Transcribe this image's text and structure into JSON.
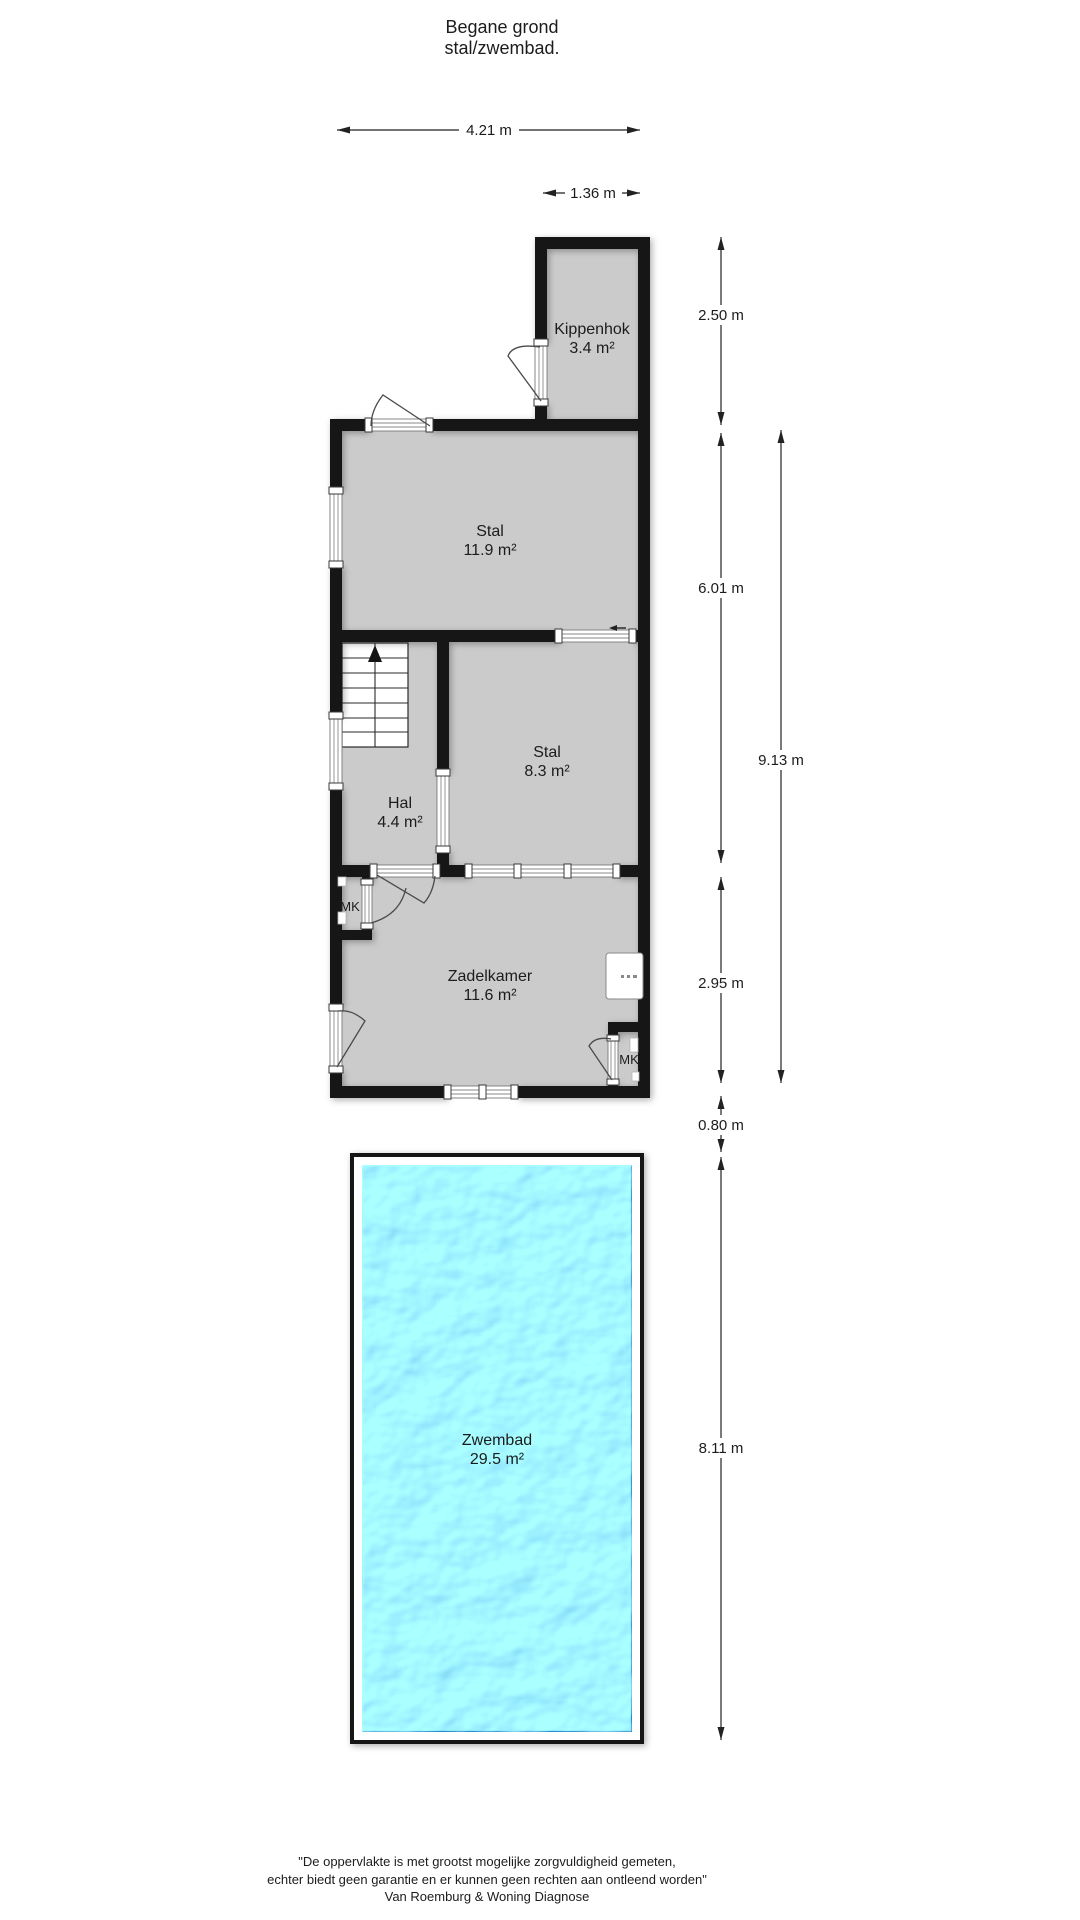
{
  "title": {
    "line1": "Begane grond",
    "line2": "stal/zwembad."
  },
  "rooms": [
    {
      "name": "Kippenhok",
      "area": "3.4 m²"
    },
    {
      "name": "Stal",
      "area": "11.9 m²"
    },
    {
      "name": "Stal",
      "area": "8.3 m²"
    },
    {
      "name": "Hal",
      "area": "4.4 m²"
    },
    {
      "name": "Zadelkamer",
      "area": "11.6 m²"
    },
    {
      "name": "Zwembad",
      "area": "29.5 m²"
    }
  ],
  "closets": [
    {
      "label": "MK"
    },
    {
      "label": "MK"
    }
  ],
  "dimensions": {
    "top_width": "4.21 m",
    "kippenhok_width": "1.36 m",
    "kippenhok_height": "2.50 m",
    "stal_section_height": "6.01 m",
    "zadelkamer_height": "2.95 m",
    "building_height": "9.13 m",
    "gap_to_pool": "0.80 m",
    "pool_height": "8.11 m"
  },
  "footer": {
    "line1": "\"De oppervlakte is met grootst mogelijke zorgvuldigheid gemeten,",
    "line2": "echter biedt geen garantie en er kunnen geen rechten aan ontleend worden\"",
    "line3": "Van Roemburg & Woning Diagnose"
  },
  "colors": {
    "wall": "#141414",
    "room-fill": "#cbcbcb",
    "line": "#222222",
    "text": "#1c1c1c",
    "water-mid": "#2b94d1",
    "water-highlight": "#8fe0f2",
    "water-deep": "#1173b4"
  }
}
